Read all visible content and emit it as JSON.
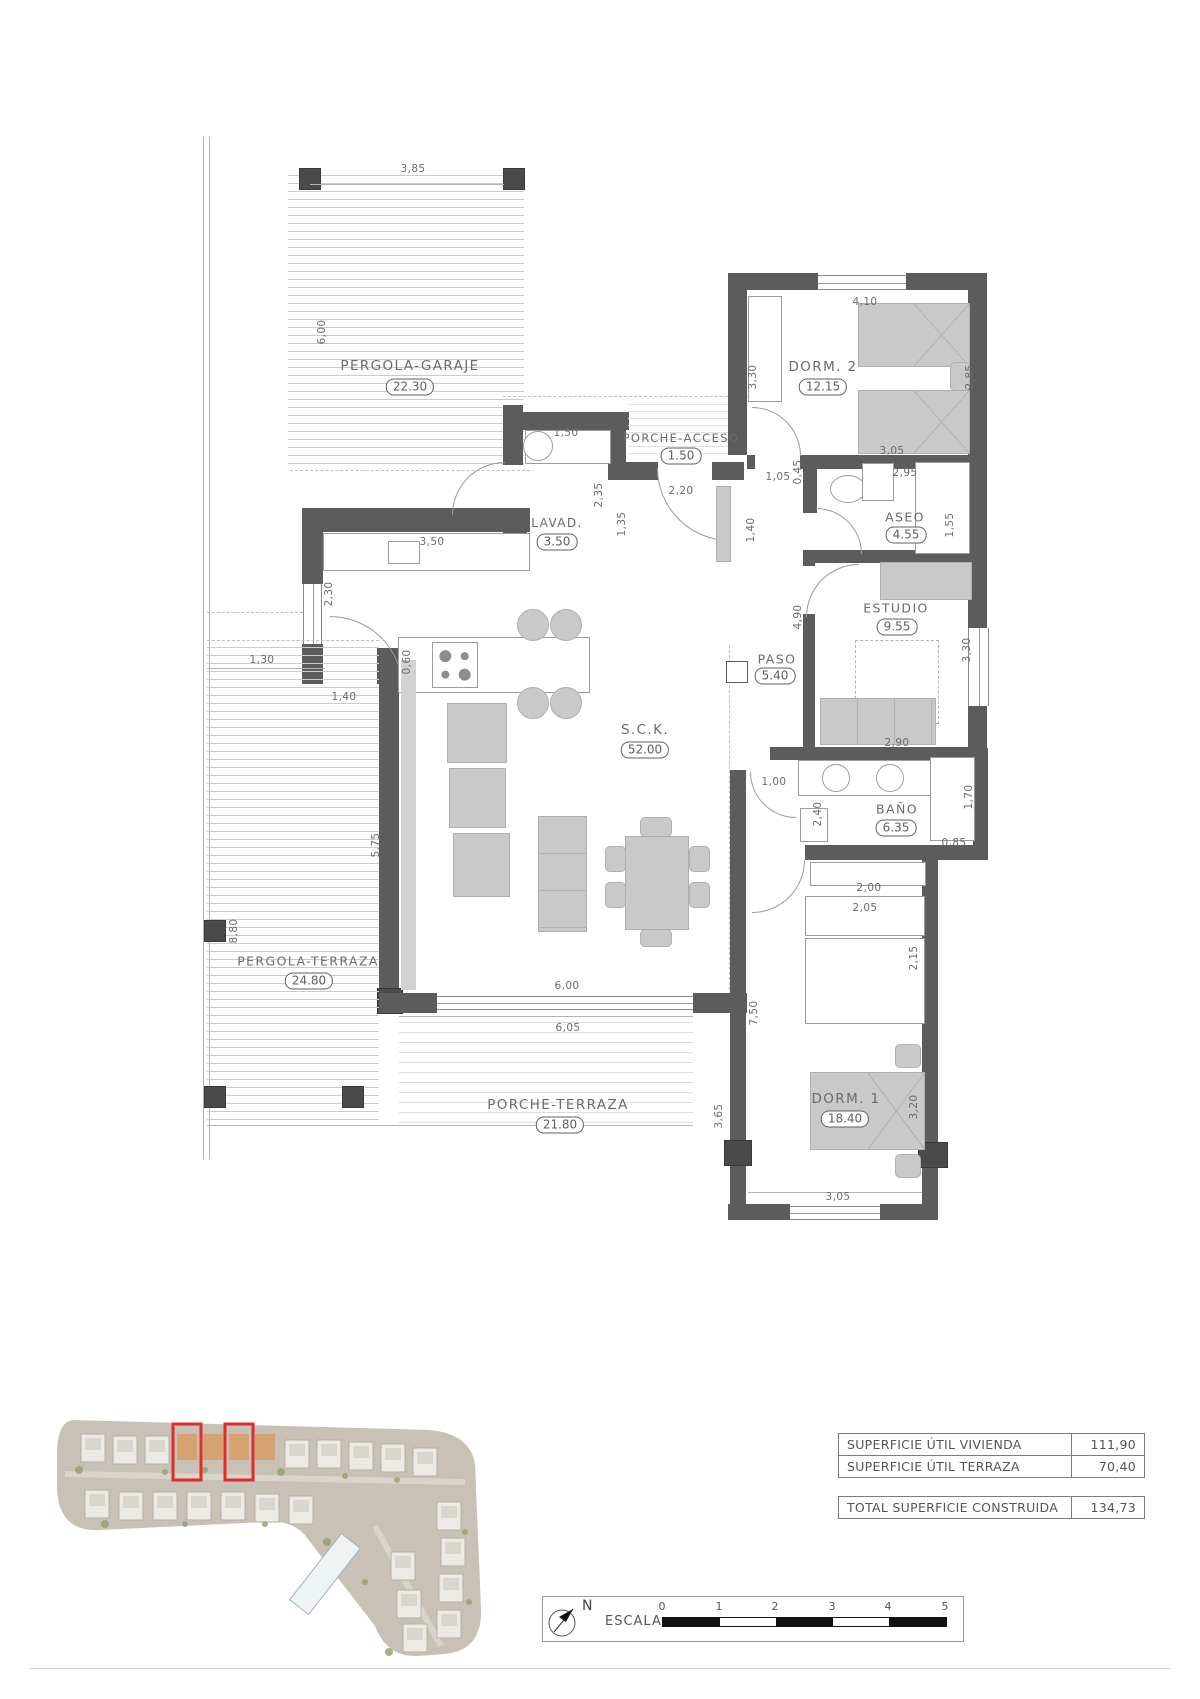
{
  "plan": {
    "rooms": {
      "pergola_garaje": {
        "name": "PERGOLA-GARAJE",
        "area": "22.30"
      },
      "porche_acceso": {
        "name": "PORCHE-ACCESO",
        "area": "1.50"
      },
      "lavadero": {
        "name": "LAVAD.",
        "area": "3.50"
      },
      "dorm2": {
        "name": "DORM. 2",
        "area": "12.15"
      },
      "aseo": {
        "name": "ASEO",
        "area": "4.55"
      },
      "estudio": {
        "name": "ESTUDIO",
        "area": "9.55"
      },
      "paso": {
        "name": "PASO",
        "area": "5.40"
      },
      "sck": {
        "name": "S.C.K.",
        "area": "52.00"
      },
      "bano": {
        "name": "BAÑO",
        "area": "6.35"
      },
      "dorm1": {
        "name": "DORM. 1",
        "area": "18.40"
      },
      "pergola_terraza": {
        "name": "PERGOLA-TERRAZA",
        "area": "24.80"
      },
      "porche_terraza": {
        "name": "PORCHE-TERRAZA",
        "area": "21.80"
      }
    },
    "dims": {
      "pergola_w": "3,85",
      "pergola_h": "6,00",
      "lavad_top": "1,50",
      "lavad_h": "2,35",
      "lavad_w2": "1,35",
      "acceso_door": "2,20",
      "acceso_h": "1,40",
      "dorm2_door": "1,05",
      "dorm2_door2": "0,45",
      "dorm2_w": "4,10",
      "dorm2_h": "3,30",
      "dorm2_bed": "2,85",
      "dorm2_bot": "3,05",
      "aseo_int": "2,95",
      "aseo_closet": "1,55",
      "estudio_h": "4,90",
      "estudio_win": "3,30",
      "estudio_sofa": "2,90",
      "kitchen_counter": "3,50",
      "kitchen_win": "2,30",
      "kitchen_isl": "0,60",
      "terr_door1": "1,30",
      "terr_door2": "1,40",
      "bano_door": "1,00",
      "bano_h": "2,40",
      "bano_w": "2,00",
      "bano_closet_h": "1,70",
      "bano_closet_w": "0,85",
      "dorm1_closet": "2,05",
      "dorm1_ward": "2,15",
      "dorm1_h": "7,50",
      "dorm1_bed": "3,20",
      "dorm1_win": "3,05",
      "porche_h": "3,65",
      "pterraza_h": "8,80",
      "pterraza_w": "5,75",
      "sck_win": "6,00",
      "sck_win2": "6,05"
    }
  },
  "summary": {
    "rows": [
      {
        "label": "SUPERFICIE ÚTIL VIVIENDA",
        "value": "111,90"
      },
      {
        "label": "SUPERFICIE ÚTIL TERRAZA",
        "value": "70,40"
      }
    ],
    "total": {
      "label": "TOTAL SUPERFICIE CONSTRUIDA",
      "value": "134,73"
    }
  },
  "scalebar": {
    "north": "N",
    "label": "ESCALA :",
    "ticks": [
      "0",
      "1",
      "2",
      "3",
      "4",
      "5"
    ]
  }
}
